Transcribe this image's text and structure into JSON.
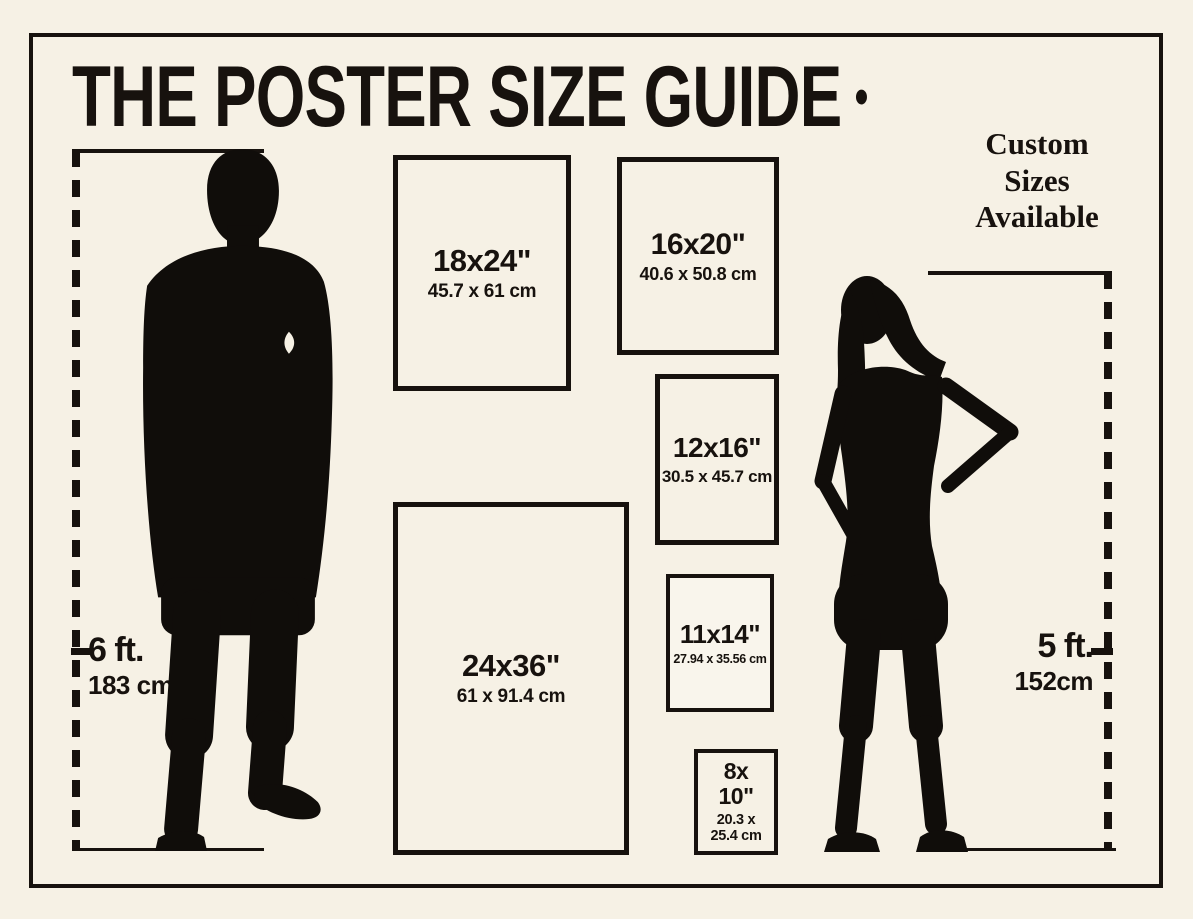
{
  "colors": {
    "background": "#f6f1e5",
    "ink": "#17120e"
  },
  "title": "THE POSTER SIZE GUIDE",
  "title_dot": "•",
  "custom_note": {
    "lines": [
      "Custom",
      "Sizes",
      "Available"
    ]
  },
  "figures": {
    "man": {
      "height_imperial": "6 ft.",
      "height_metric": "183 cm"
    },
    "woman": {
      "height_imperial": "5 ft.",
      "height_metric": "152cm"
    }
  },
  "posters": [
    {
      "id": "18x24",
      "label": "18x24\"",
      "metric": "45.7 x 61 cm"
    },
    {
      "id": "16x20",
      "label": "16x20\"",
      "metric": "40.6 x 50.8 cm"
    },
    {
      "id": "12x16",
      "label": "12x16\"",
      "metric": "30.5 x 45.7 cm"
    },
    {
      "id": "24x36",
      "label": "24x36\"",
      "metric": "61 x 91.4 cm"
    },
    {
      "id": "11x14",
      "label": "11x14\"",
      "metric": "27.94 x 35.56 cm"
    },
    {
      "id": "8x10",
      "label": "8x 10\"",
      "metric": "20.3 x 25.4 cm"
    }
  ]
}
